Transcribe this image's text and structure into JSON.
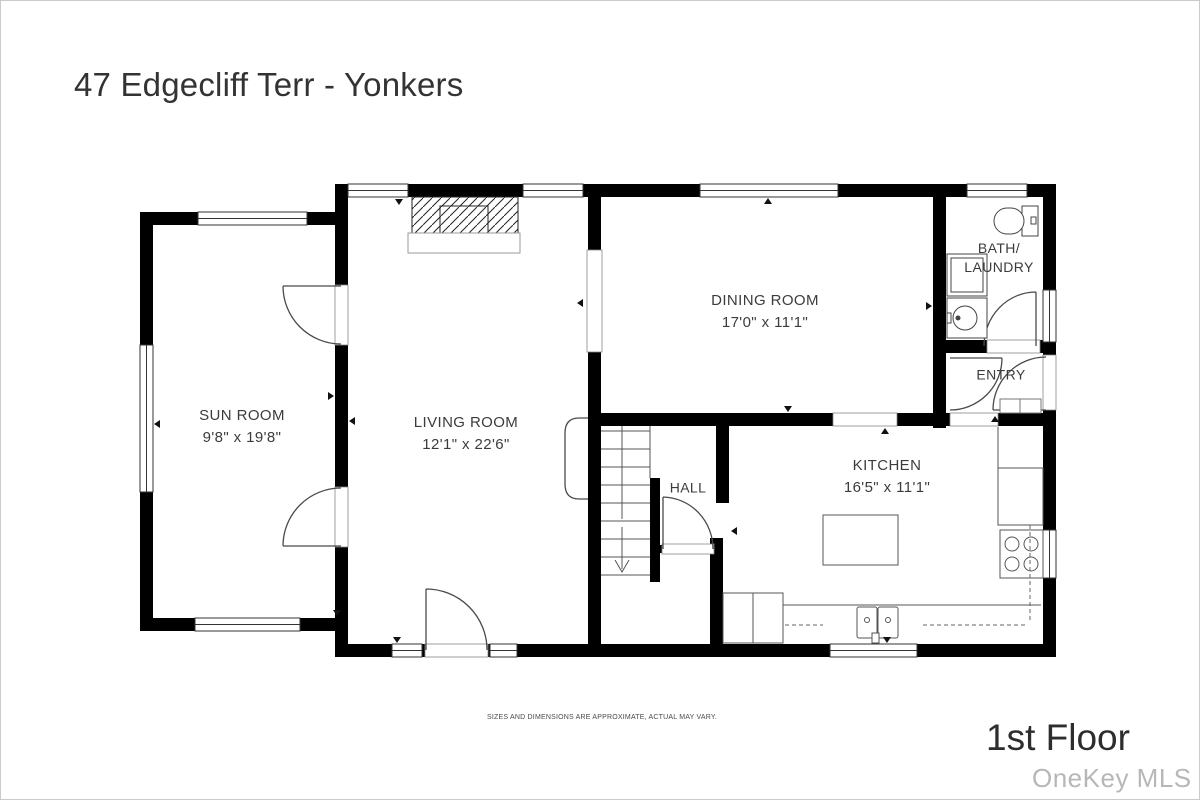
{
  "header": {
    "title": "47 Edgecliff Terr - Yonkers"
  },
  "footer": {
    "disclaimer": "SIZES AND DIMENSIONS ARE APPROXIMATE, ACTUAL MAY VARY.",
    "floor_label": "1st Floor",
    "watermark": "OneKey MLS"
  },
  "rooms": [
    {
      "name": "SUN ROOM",
      "dims": "9'8\" x 19'8\""
    },
    {
      "name": "LIVING ROOM",
      "dims": "12'1\" x 22'6\""
    },
    {
      "name": "DINING ROOM",
      "dims": "17'0\" x 11'1\""
    },
    {
      "name": "BATH/",
      "name2": "LAUNDRY"
    },
    {
      "name": "ENTRY"
    },
    {
      "name": "HALL"
    },
    {
      "name": "KITCHEN",
      "dims": "16'5\" x 11'1\""
    }
  ],
  "colors": {
    "wall": "#000000",
    "line": "#4a4a4a",
    "text": "#3c3c3c",
    "watermark": "#b7b7b9"
  }
}
